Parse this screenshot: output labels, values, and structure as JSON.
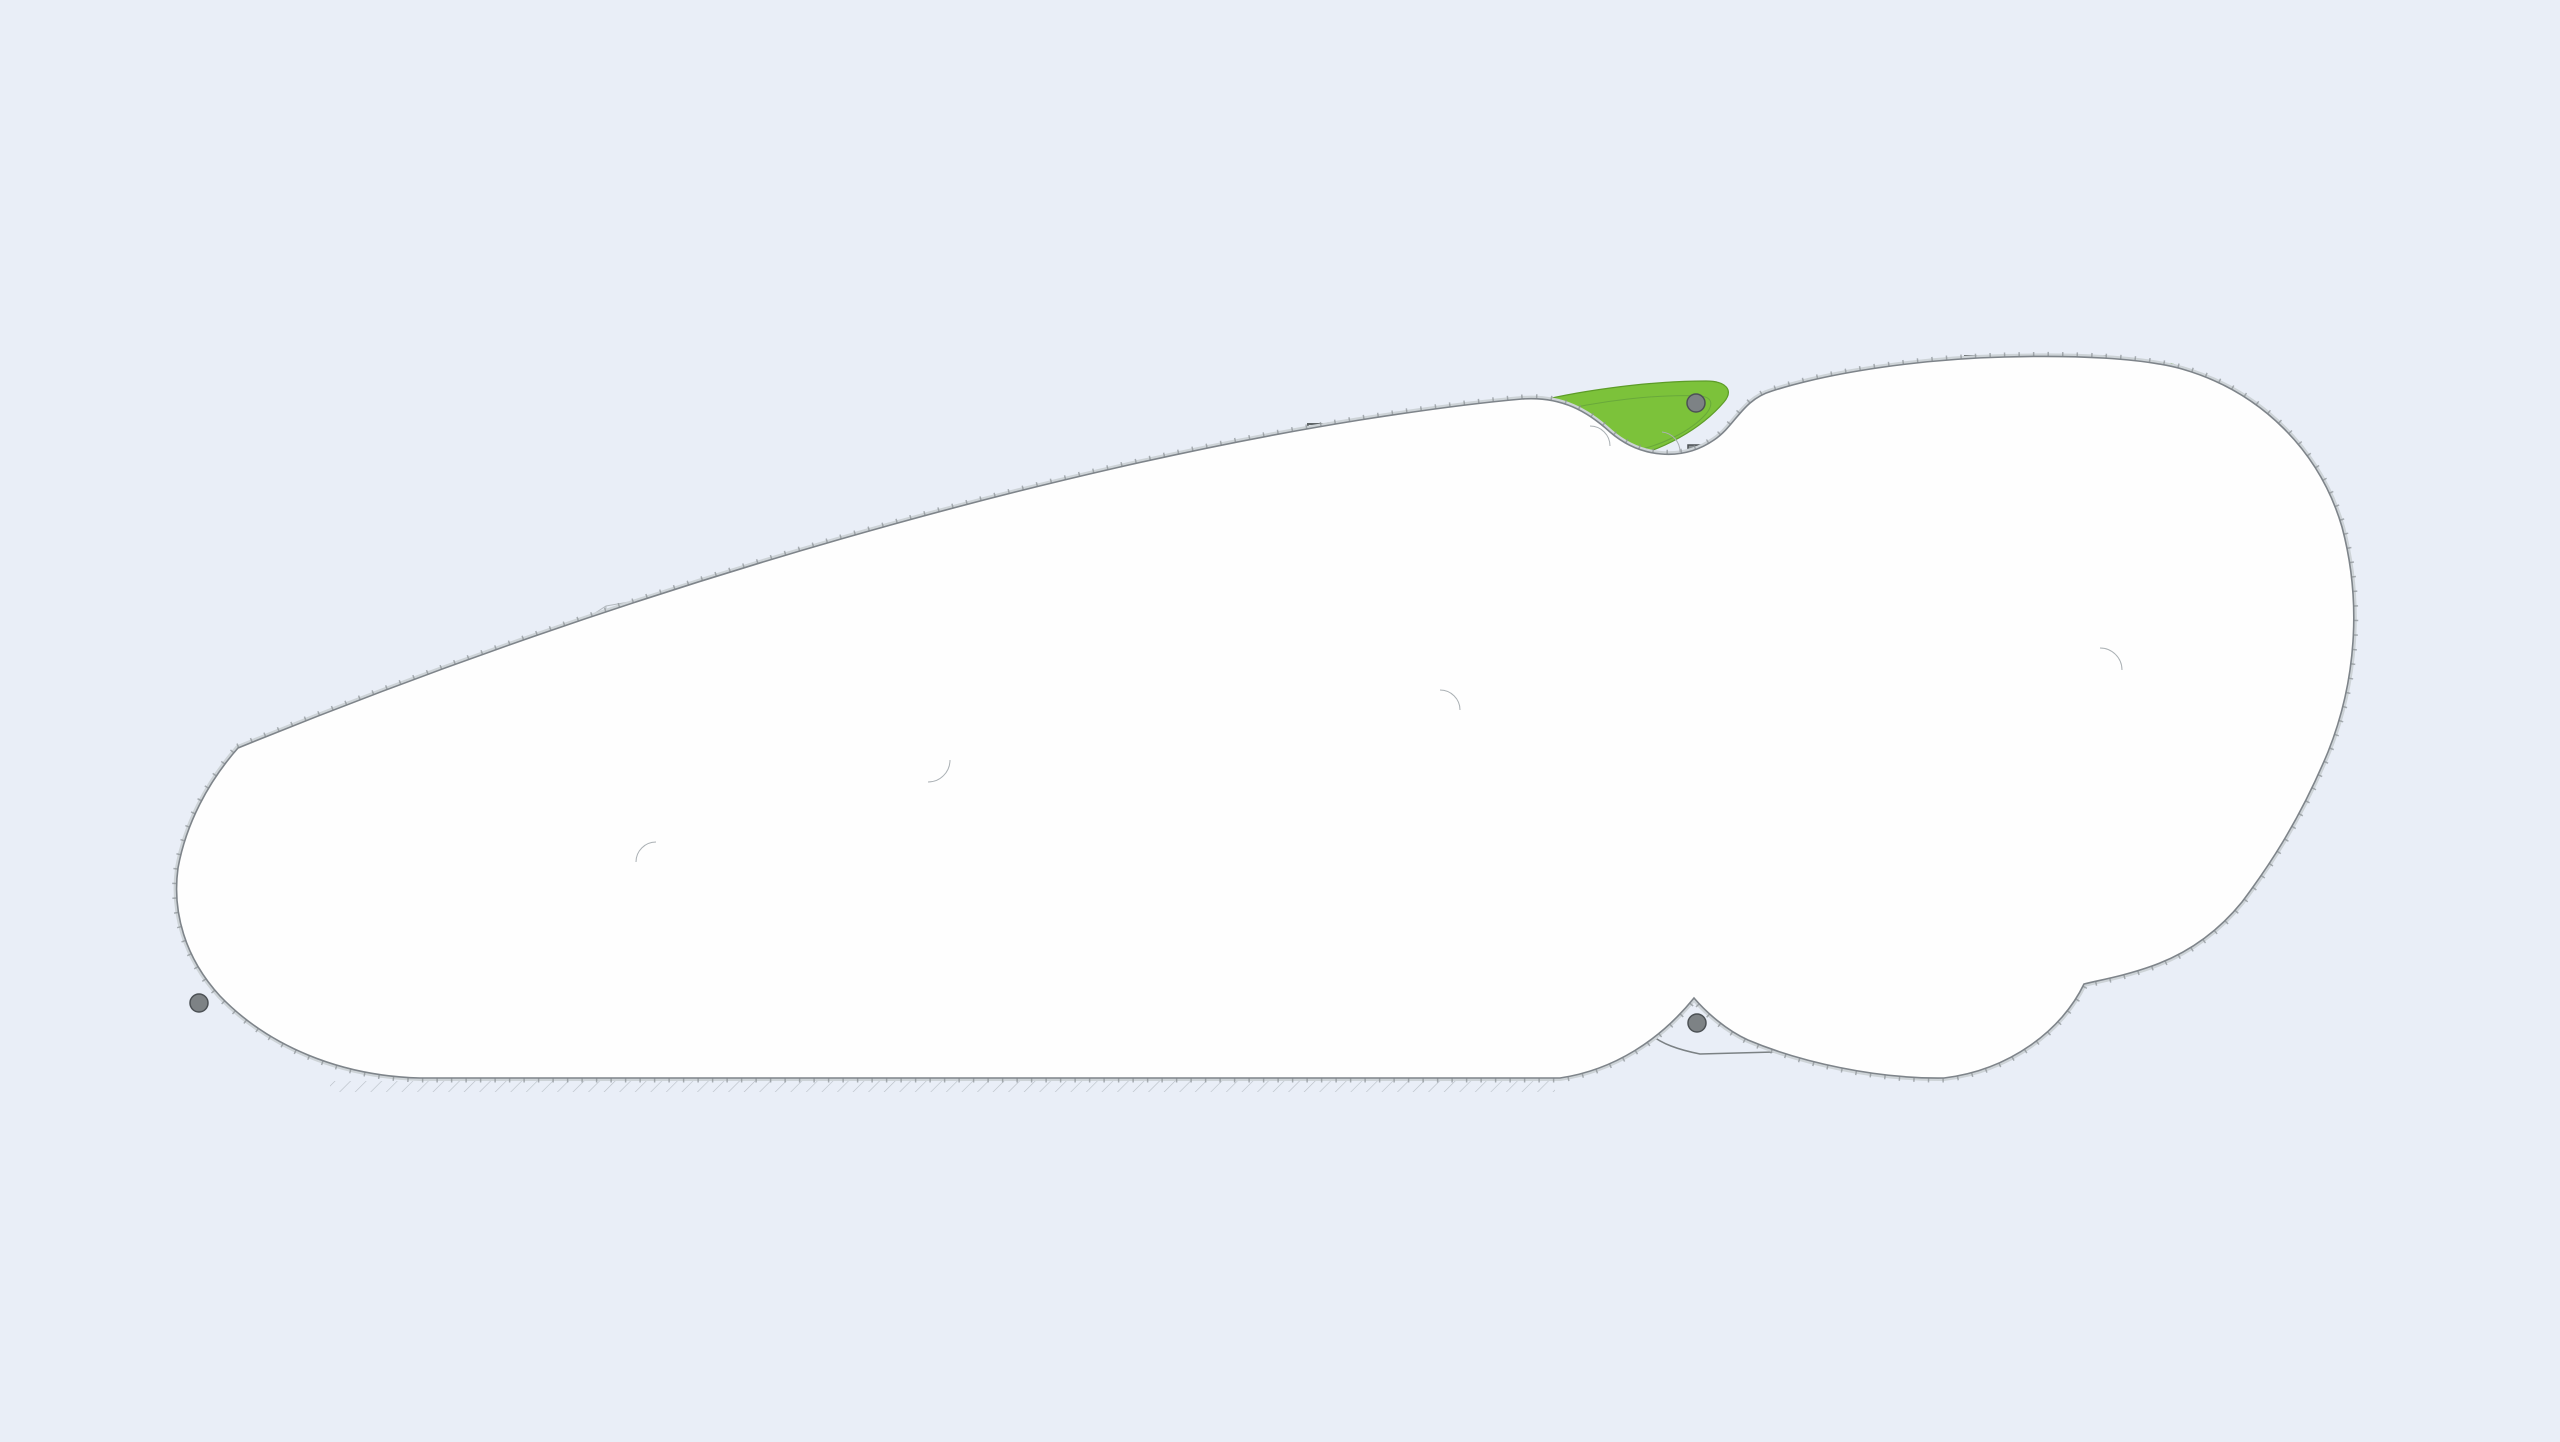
{
  "canvas": {
    "background": "#e9eef7"
  },
  "palette": {
    "floor_white": "#fefefe",
    "zone_gray": "#d3d8db",
    "room_gray": "#dde1e4",
    "wall_gray": "#5f6568",
    "column_gray": "#7d8285",
    "lavatory_blue": "#a8daf1",
    "corridor_blue": "#c9e9f7",
    "lift_lobby_blue": "#bfe5f6",
    "landscape_green": "#7cc23a"
  },
  "rooms": {
    "pantry": "Pantry",
    "executive_lavatory": "Executive Lavatory",
    "male_lavatory": "Male Lavatory",
    "female_lavatory": "Female Lavatory",
    "disabled_lavatory": "Disabled Lavatory",
    "lift_lobby": "Lift Lobby"
  },
  "lifts": {
    "service_lift": "S.L.",
    "passenger_lift": "P.L."
  },
  "annotations": {
    "staircase_to_7f": "Staircase to 7/F"
  }
}
